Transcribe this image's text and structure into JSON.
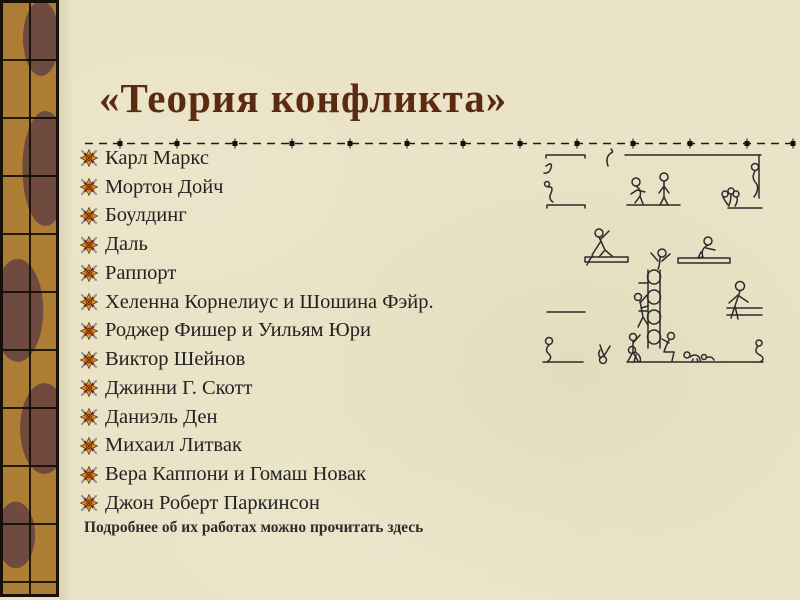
{
  "slide": {
    "title": "«Теория конфликта»",
    "footer_note": "Подробнее об их работах можно прочитать здесь"
  },
  "list": {
    "items": [
      "Карл Маркс",
      "Мортон Дойч",
      "Боулдинг",
      "Даль",
      "Раппорт",
      "Хеленна Корнелиус и Шошина Фэйр.",
      "Роджер Фишер и Уильям Юри",
      "Виктор Шейнов",
      "Джинни Г. Скотт",
      "Даниэль Ден",
      "Михаил Литвак",
      "Вера Каппони и Гомаш Новак",
      "Джон Роберт Паркинсон"
    ]
  },
  "icons": {
    "bullet": "compass-star-icon",
    "illustration": "stick-figures-platforms-ladder-sketch"
  },
  "colors": {
    "background": "#EAE3C7",
    "title": "#5A2B10",
    "text": "#222222",
    "sidebar_tan": "#AC7D33",
    "sidebar_brown": "#6E4B40",
    "bullet_gold": "#D79A28",
    "bullet_red": "#7E2610",
    "bullet_gray": "#9097A0",
    "line": "#1A1A1A"
  }
}
